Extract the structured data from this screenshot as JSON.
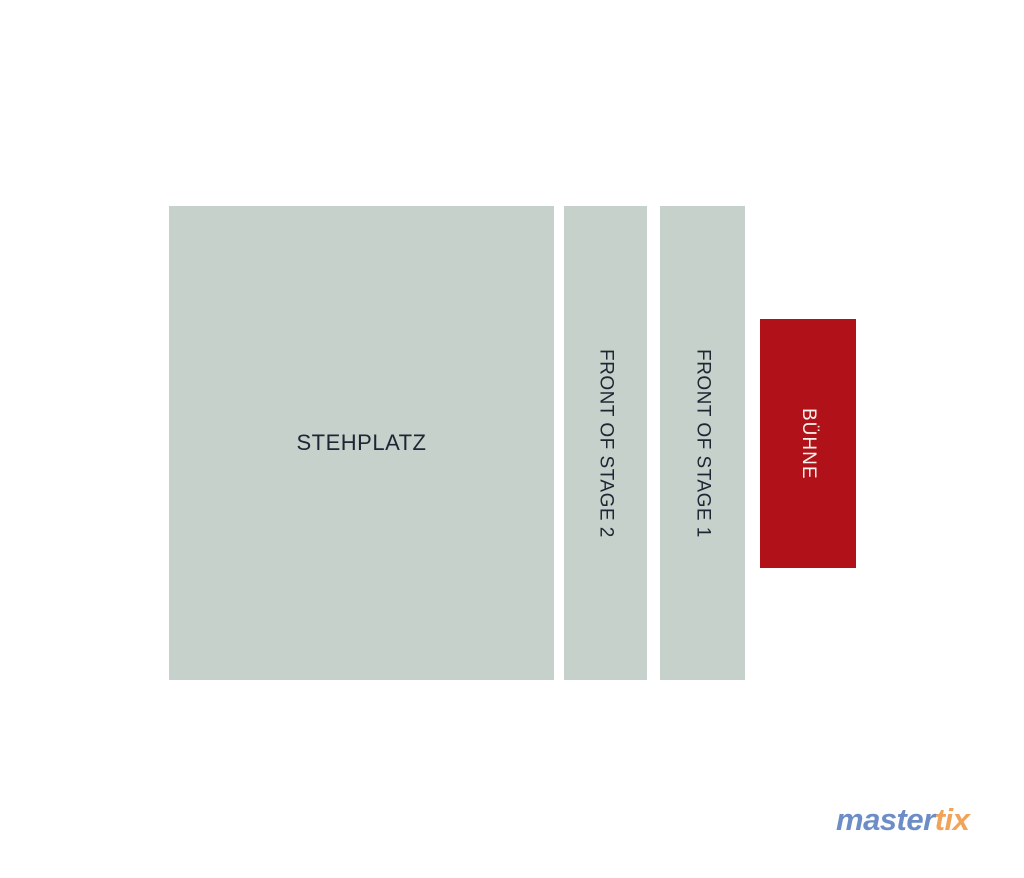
{
  "page": {
    "background_color": "#ffffff",
    "type": "venue-seating-map"
  },
  "map": {
    "areas": [
      {
        "name": "stehplatz",
        "label": "STEHPLATZ",
        "kind": "standing-area",
        "fill_color": "#c5d1ca",
        "text_color": "#1d2634",
        "orientation": "horizontal"
      },
      {
        "name": "front-of-stage-2",
        "label": "FRONT OF STAGE 2",
        "kind": "standing-area",
        "fill_color": "#c5d1ca",
        "text_color": "#1d2634",
        "orientation": "vertical"
      },
      {
        "name": "front-of-stage-1",
        "label": "FRONT OF STAGE 1",
        "kind": "standing-area",
        "fill_color": "#c5d1ca",
        "text_color": "#1d2634",
        "orientation": "vertical"
      },
      {
        "name": "buehne",
        "label": "BÜHNE",
        "kind": "stage",
        "fill_color": "#b1121a",
        "text_color": "#f7f2ec",
        "orientation": "vertical"
      }
    ]
  },
  "branding": {
    "logo": {
      "part1": "master",
      "part1_color": "#6d8dc7",
      "part2": "tix",
      "part2_color": "#f2a35a"
    }
  }
}
